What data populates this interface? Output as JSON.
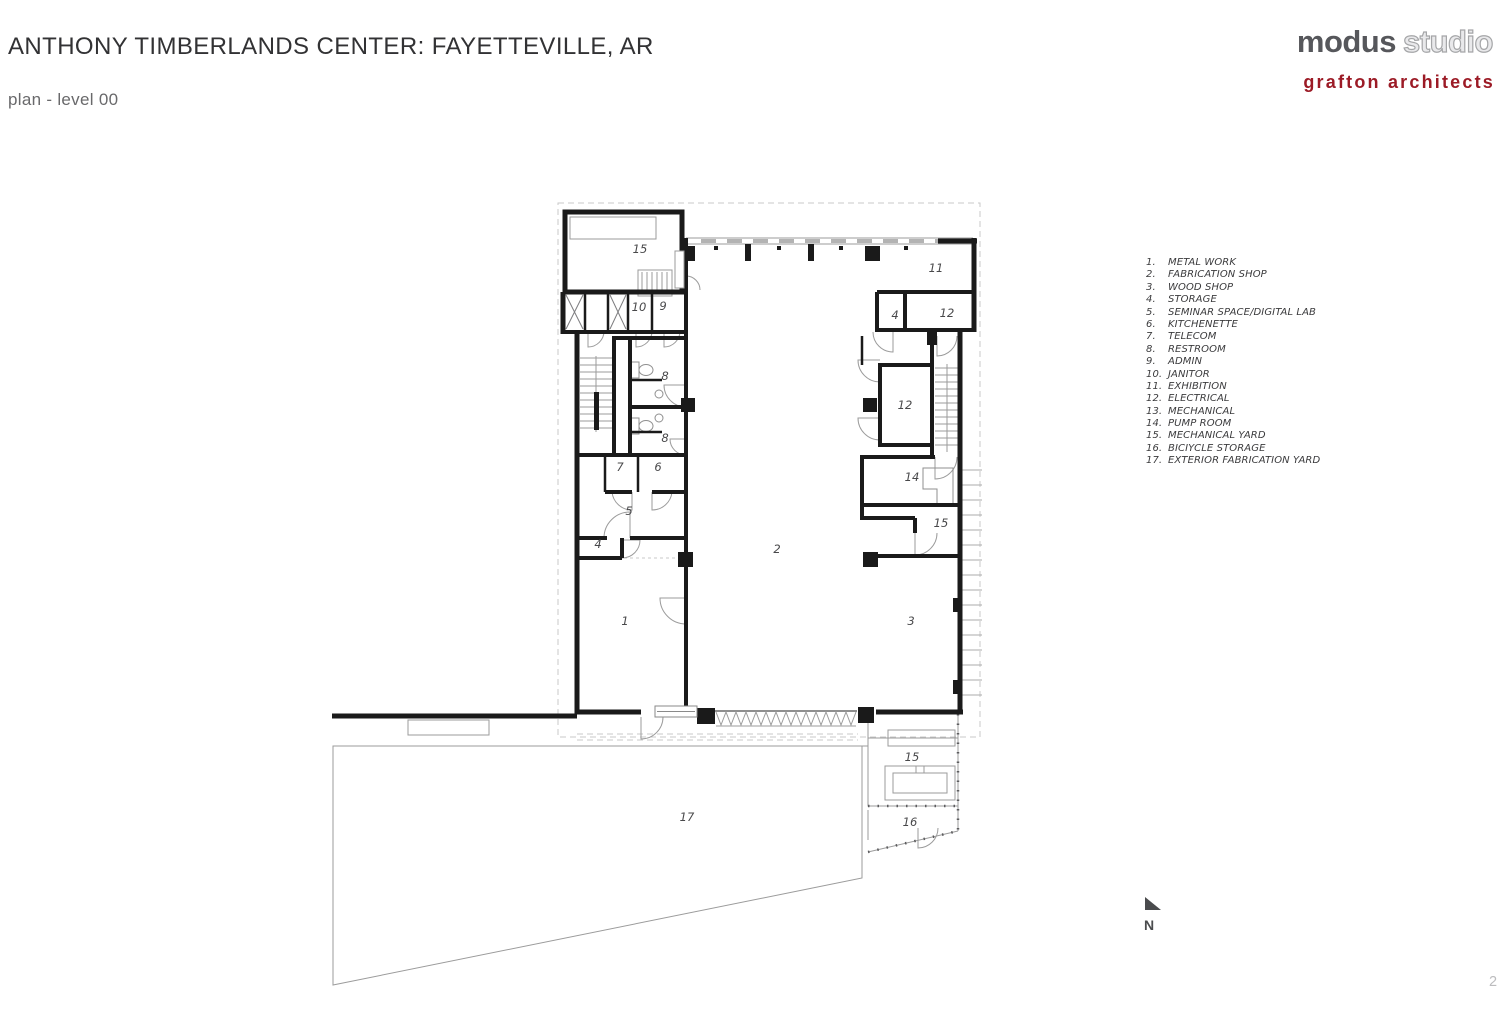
{
  "header": {
    "title": "ANTHONY TIMBERLANDS CENTER: FAYETTEVILLE, AR",
    "subtitle": "plan - level 00"
  },
  "branding": {
    "modus_word": "modus",
    "studio_word": "studio",
    "grafton": "grafton architects",
    "modus_color": "#56575b",
    "grafton_color": "#9c1b26"
  },
  "legend": {
    "items": [
      {
        "num": "1.",
        "label": "METAL WORK"
      },
      {
        "num": "2.",
        "label": "FABRICATION SHOP"
      },
      {
        "num": "3.",
        "label": "WOOD SHOP"
      },
      {
        "num": "4.",
        "label": "STORAGE"
      },
      {
        "num": "5.",
        "label": "SEMINAR SPACE/DIGITAL LAB"
      },
      {
        "num": "6.",
        "label": "KITCHENETTE"
      },
      {
        "num": "7.",
        "label": "TELECOM"
      },
      {
        "num": "8.",
        "label": "RESTROOM"
      },
      {
        "num": "9.",
        "label": "ADMIN"
      },
      {
        "num": "10.",
        "label": "JANITOR"
      },
      {
        "num": "11.",
        "label": "EXHIBITION"
      },
      {
        "num": "12.",
        "label": "ELECTRICAL"
      },
      {
        "num": "13.",
        "label": "MECHANICAL"
      },
      {
        "num": "14.",
        "label": "PUMP ROOM"
      },
      {
        "num": "15.",
        "label": "MECHANICAL YARD"
      },
      {
        "num": "16.",
        "label": "BICIYCLE STORAGE"
      },
      {
        "num": "17.",
        "label": "EXTERIOR FABRICATION YARD"
      }
    ]
  },
  "plan": {
    "room_labels": [
      {
        "text": "15",
        "x": 640,
        "y": 253
      },
      {
        "text": "11",
        "x": 936,
        "y": 272
      },
      {
        "text": "10",
        "x": 639,
        "y": 311
      },
      {
        "text": "9",
        "x": 663,
        "y": 310
      },
      {
        "text": "4",
        "x": 895,
        "y": 319
      },
      {
        "text": "12",
        "x": 947,
        "y": 317
      },
      {
        "text": "8",
        "x": 665,
        "y": 380
      },
      {
        "text": "12",
        "x": 905,
        "y": 409
      },
      {
        "text": "8",
        "x": 665,
        "y": 442
      },
      {
        "text": "7",
        "x": 620,
        "y": 471
      },
      {
        "text": "6",
        "x": 658,
        "y": 471
      },
      {
        "text": "14",
        "x": 912,
        "y": 481
      },
      {
        "text": "5",
        "x": 629,
        "y": 515
      },
      {
        "text": "15",
        "x": 941,
        "y": 527
      },
      {
        "text": "4",
        "x": 598,
        "y": 548
      },
      {
        "text": "2",
        "x": 777,
        "y": 553
      },
      {
        "text": "1",
        "x": 625,
        "y": 625
      },
      {
        "text": "3",
        "x": 911,
        "y": 625
      },
      {
        "text": "15",
        "x": 912,
        "y": 761
      },
      {
        "text": "17",
        "x": 687,
        "y": 821
      },
      {
        "text": "16",
        "x": 910,
        "y": 826
      }
    ]
  },
  "north": {
    "label": "N"
  },
  "footer": {
    "page_number": "2"
  }
}
